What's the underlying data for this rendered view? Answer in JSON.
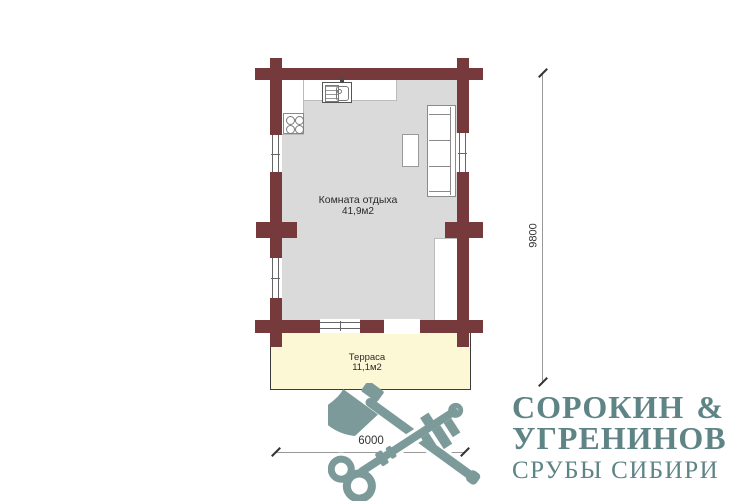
{
  "plan": {
    "room": {
      "label": "Комната отдыха",
      "area": "41,9м2"
    },
    "terrace": {
      "label": "Терраса",
      "area": "11,1м2"
    },
    "dim_vertical": "9800",
    "dim_horizontal": "6000",
    "furniture": [
      "kitchen-sink",
      "stove",
      "dining-table",
      "sofa"
    ],
    "colors": {
      "wall": "#763a3c",
      "room_floor": "#dadada",
      "terrace_fill": "#fcf8d5",
      "terrace_border": "#3c3c3c",
      "dim_line": "#999999",
      "dim_text": "#333333"
    }
  },
  "logo": {
    "line1_left": "СОРОКИН",
    "line1_right": "&",
    "line2": "УГРЕНИНОВ",
    "line3": "СРУБЫ СИБИРИ",
    "text_color": "#5f8486",
    "mark_color": "#7d9a9a",
    "mark_icons": [
      "axe-icon",
      "key-icon"
    ]
  }
}
